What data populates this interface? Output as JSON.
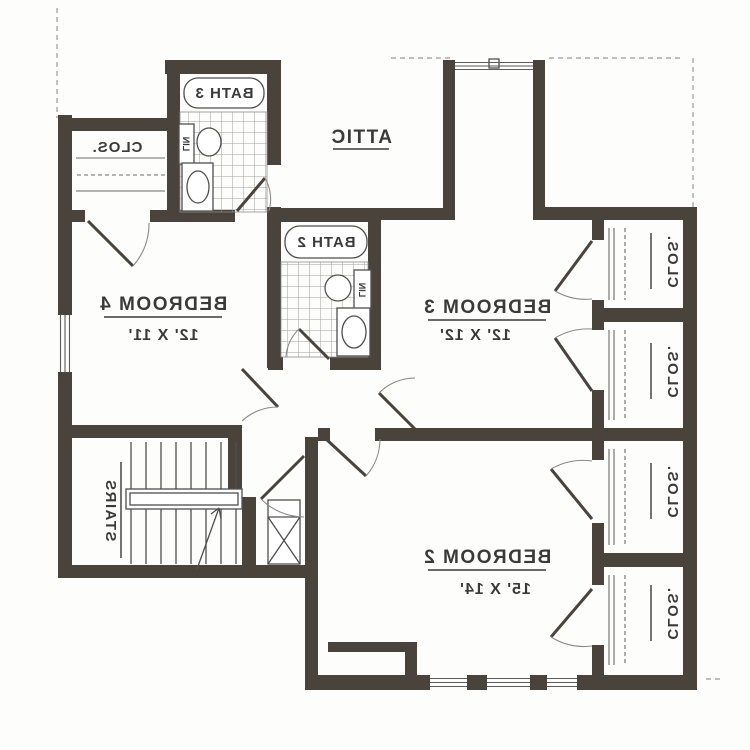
{
  "colors": {
    "wall": "#4a433b",
    "line": "#4f4f4f",
    "text": "#3a3a3a",
    "dash": "#9a9a9a",
    "bg": "#fdfdfc"
  },
  "plan": {
    "mirrored": true,
    "rooms": {
      "bedroom2": {
        "name": "BEDROOM 2",
        "dims": "15' X 14'"
      },
      "bedroom3": {
        "name": "BEDROOM 3",
        "dims": "12' X 12'"
      },
      "bedroom4": {
        "name": "BEDROOM 4",
        "dims": "12' X 11'"
      },
      "attic": {
        "name": "ATTIC"
      },
      "bath2": {
        "name": "BATH 2"
      },
      "bath3": {
        "name": "BATH 3"
      },
      "stairs": {
        "name": "STAIRS"
      }
    },
    "closet_label": "CLOS.",
    "linen_label": "LIN"
  }
}
